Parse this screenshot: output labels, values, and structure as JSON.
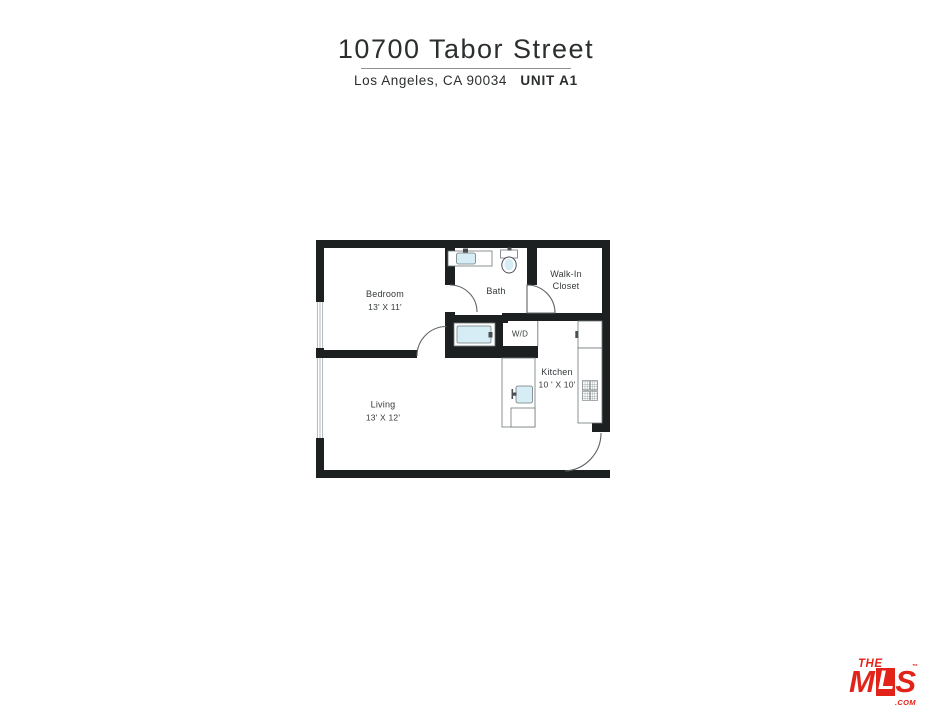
{
  "header": {
    "address": "10700 Tabor Street",
    "city_line": "Los Angeles, CA 90034",
    "unit": "UNIT A1"
  },
  "floorplan": {
    "bedroom": {
      "name": "Bedroom",
      "dims": "13' X 11'"
    },
    "bath": {
      "name": "Bath"
    },
    "closet": {
      "line1": "Walk-In",
      "line2": "Closet"
    },
    "laundry": {
      "name": "W/D"
    },
    "kitchen": {
      "name": "Kitchen",
      "dims": "10 ' X 10'"
    },
    "living": {
      "name": "Living",
      "dims": "13' X 12'"
    }
  },
  "logo": {
    "the": "THE",
    "m": "M",
    "l": "L",
    "s": "S",
    "tm": "™",
    "com": ".COM",
    "brand_color": "#e2231a"
  },
  "colors": {
    "wall": "#1d2021",
    "fixture_blue": "#d6edf6",
    "line_gray": "#70787a",
    "window_line": "#a9b3b5",
    "text_dark": "#34383a",
    "accent_red": "#e2231a"
  }
}
